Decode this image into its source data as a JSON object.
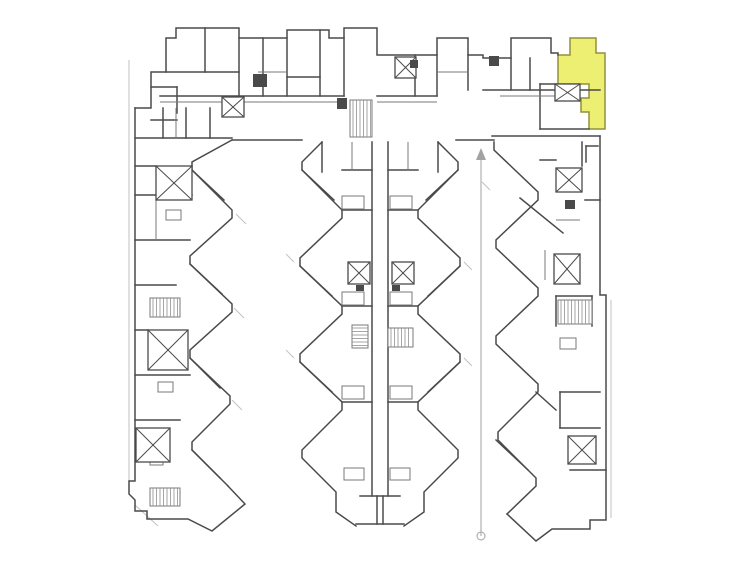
{
  "palette": {
    "background": "#ffffff",
    "wall": "#4a4a4a",
    "wall_soft": "#7a7a7a",
    "faint": "#c2c2c2",
    "hatch": "#909090",
    "highlight_fill": "#edef72",
    "highlight_stroke": "#92903e",
    "dimension": "#a2a2a2"
  },
  "plan": {
    "viewbox": "0 0 756 567",
    "highlight_unit": {
      "points": "570,38 596,38 596,53 605,53 605,129 589,129 589,112 581,112 581,98 589,98 589,84 558,84 558,55 570,55"
    },
    "walls": {
      "top_bar": [
        "M135,108 L151,108 L151,72 L166,72 L166,38 L176,38 L176,28 L239,28 L239,38 L287,38 L287,30 L329,30 L329,38 L344,38 L344,28 L377,28 L377,55 L391,55 L437,55 L437,38 L468,38 L468,55 L483,55 L483,58 L511,58 L511,38 L551,38 L551,53 L558,53 L558,55",
        "M205,28 L205,72",
        "M166,72 L239,72",
        "M239,38 L239,96",
        "M263,38 L263,96",
        "M287,38 L287,96",
        "M287,77 L320,77",
        "M320,30 L320,96",
        "M344,38 L344,96",
        "M160,96 L344,96",
        "M377,96 L437,96",
        "M135,138 L232,138",
        "M163,108 L163,138",
        "M186,108 L186,138",
        "M210,108 L210,138",
        "M151,87 L177,87",
        "M177,87 L177,113",
        "M151,120 L177,120",
        "M415,55 L415,96",
        "M437,55 L437,96",
        "M468,55 L468,90",
        "M483,90 L600,90",
        "M511,58 L511,90",
        "M530,58 L530,90",
        "M540,84 L558,84",
        "M540,84 L540,129",
        "M540,129 L589,129",
        "M492,136 L600,136",
        "M232,140 L302,140",
        "M456,140 L494,140"
      ],
      "left_wing": [
        "M135,108 L135,481 L129,481 L129,494 L135,500 L135,511 L147,511 L147,519 L188,519 L212,531 L245,504 L228,486",
        "M232,140 L192,162 L192,170 L232,210 L232,218 L190,256 L190,264 L232,304 L232,312 L190,350 L190,358 L230,396 L230,404 L192,442 L192,450 L228,486",
        "M135,195 L192,195",
        "M135,240 L190,240",
        "M135,285 L176,285",
        "M135,375 L190,375",
        "M135,420 L180,420",
        "M192,170 L224,200",
        "M190,264 L222,294",
        "M190,358 L220,388",
        "M192,450 L220,478",
        "M135,166 L156,166",
        "M135,330 L148,330"
      ],
      "center_wing": [
        "M322,142 L302,162 L302,170 L342,210 L342,218 L300,258 L300,266 L342,306 L342,314 L300,354 L300,362 L342,402 L342,410 L302,450 L302,458 L336,492 L336,512 L356,526",
        "M438,142 L458,162 L458,170 L418,210 L418,218 L460,258 L460,266 L418,306 L418,314 L460,354 L460,362 L418,402 L418,410 L458,450 L458,458 L424,492 L424,512 L404,526",
        "M372,142 L372,496",
        "M388,142 L388,496",
        "M360,496 L400,496",
        "M377,496 L377,524",
        "M383,496 L383,524",
        "M356,524 L404,524",
        "M342,210 L372,210",
        "M388,210 L418,210",
        "M342,306 L372,306",
        "M388,306 L418,306",
        "M342,402 L372,402",
        "M388,402 L418,402",
        "M322,142 L322,172",
        "M438,142 L438,172",
        "M342,170 L372,170",
        "M388,170 L418,170",
        "M302,170 L334,200",
        "M458,170 L426,200",
        "M300,266 L332,296",
        "M460,266 L428,296",
        "M300,362 L332,392",
        "M460,362 L428,392"
      ],
      "right_wing": [
        "M494,142 L494,150 L538,192 L538,200 L496,240 L496,248 L538,288 L538,296 L496,336 L496,344 L538,384 L538,392 L498,432 L498,440 L536,478 L536,486 L507,514",
        "M600,136 L600,295 L606,295 L606,520 L590,520 L590,529 L552,529 L536,541 L507,514",
        "M520,198 L563,233",
        "M582,142 L582,166",
        "M540,160 L556,160",
        "M585,200 L600,200",
        "M556,296 L556,326",
        "M592,296 L592,326",
        "M556,296 L592,296",
        "M560,392 L600,392",
        "M560,392 L560,428",
        "M560,428 L600,428",
        "M496,440 L528,470",
        "M570,470 L606,470",
        "M536,392 L556,410",
        "M586,146 L598,146",
        "M586,146 L586,162"
      ]
    },
    "soft_walls": [
      "M160,102 L344,102",
      "M377,102 L437,102",
      "M500,96 L560,96",
      "M156,200 L156,240",
      "M176,108 L176,138",
      "M352,142 L352,170",
      "M408,142 L408,170",
      "M556,220 L580,220",
      "M545,250 L545,280",
      "M258,72 L287,72",
      "M437,72 L468,72"
    ],
    "room_outlines": [
      {
        "x": 342,
        "y": 196,
        "w": 22,
        "h": 13
      },
      {
        "x": 390,
        "y": 196,
        "w": 22,
        "h": 13
      },
      {
        "x": 342,
        "y": 292,
        "w": 22,
        "h": 13
      },
      {
        "x": 390,
        "y": 292,
        "w": 22,
        "h": 13
      },
      {
        "x": 342,
        "y": 386,
        "w": 22,
        "h": 13
      },
      {
        "x": 390,
        "y": 386,
        "w": 22,
        "h": 13
      },
      {
        "x": 344,
        "y": 468,
        "w": 20,
        "h": 12
      },
      {
        "x": 390,
        "y": 468,
        "w": 20,
        "h": 12
      },
      {
        "x": 166,
        "y": 210,
        "w": 15,
        "h": 10
      },
      {
        "x": 158,
        "y": 382,
        "w": 15,
        "h": 10
      },
      {
        "x": 150,
        "y": 456,
        "w": 13,
        "h": 9
      },
      {
        "x": 560,
        "y": 338,
        "w": 16,
        "h": 11
      }
    ],
    "faint_lines": [
      "M129,60 L129,481",
      "M135,505 L158,526",
      "M611,300 L611,518",
      "M236,214 L246,224",
      "M234,308 L244,318",
      "M232,400 L242,410",
      "M294,262 L286,254",
      "M294,358 L286,350",
      "M464,262 L472,270",
      "M464,358 L472,366",
      "M490,190 L482,182"
    ],
    "cores": [
      {
        "x": 222,
        "y": 97,
        "w": 22,
        "h": 20
      },
      {
        "x": 395,
        "y": 57,
        "w": 21,
        "h": 21
      },
      {
        "x": 555,
        "y": 84,
        "w": 25,
        "h": 17
      },
      {
        "x": 156,
        "y": 166,
        "w": 36,
        "h": 34
      },
      {
        "x": 148,
        "y": 330,
        "w": 40,
        "h": 40
      },
      {
        "x": 136,
        "y": 428,
        "w": 34,
        "h": 34
      },
      {
        "x": 348,
        "y": 262,
        "w": 22,
        "h": 22
      },
      {
        "x": 392,
        "y": 262,
        "w": 22,
        "h": 22
      },
      {
        "x": 556,
        "y": 168,
        "w": 26,
        "h": 24
      },
      {
        "x": 554,
        "y": 254,
        "w": 26,
        "h": 30
      },
      {
        "x": 568,
        "y": 436,
        "w": 28,
        "h": 28
      }
    ],
    "stairs": [
      {
        "x": 350,
        "y": 100,
        "w": 22,
        "h": 37,
        "dir": "v"
      },
      {
        "x": 150,
        "y": 298,
        "w": 30,
        "h": 19,
        "dir": "v"
      },
      {
        "x": 150,
        "y": 488,
        "w": 30,
        "h": 18,
        "dir": "v"
      },
      {
        "x": 352,
        "y": 325,
        "w": 16,
        "h": 23,
        "dir": "h"
      },
      {
        "x": 388,
        "y": 328,
        "w": 25,
        "h": 19,
        "dir": "v"
      },
      {
        "x": 558,
        "y": 300,
        "w": 34,
        "h": 24,
        "dir": "v"
      }
    ],
    "solids": [
      {
        "x": 253,
        "y": 74,
        "w": 14,
        "h": 13
      },
      {
        "x": 489,
        "y": 56,
        "w": 10,
        "h": 10
      },
      {
        "x": 410,
        "y": 60,
        "w": 8,
        "h": 8
      },
      {
        "x": 337,
        "y": 98,
        "w": 10,
        "h": 11
      },
      {
        "x": 565,
        "y": 200,
        "w": 10,
        "h": 9
      },
      {
        "x": 356,
        "y": 285,
        "w": 8,
        "h": 6
      },
      {
        "x": 392,
        "y": 285,
        "w": 8,
        "h": 6
      }
    ],
    "dimension": {
      "x": 481,
      "y1": 152,
      "y2": 536,
      "arrow_points": "481,148 476,160 486,160",
      "circle": {
        "cx": 481,
        "cy": 536,
        "r": 4
      }
    }
  }
}
